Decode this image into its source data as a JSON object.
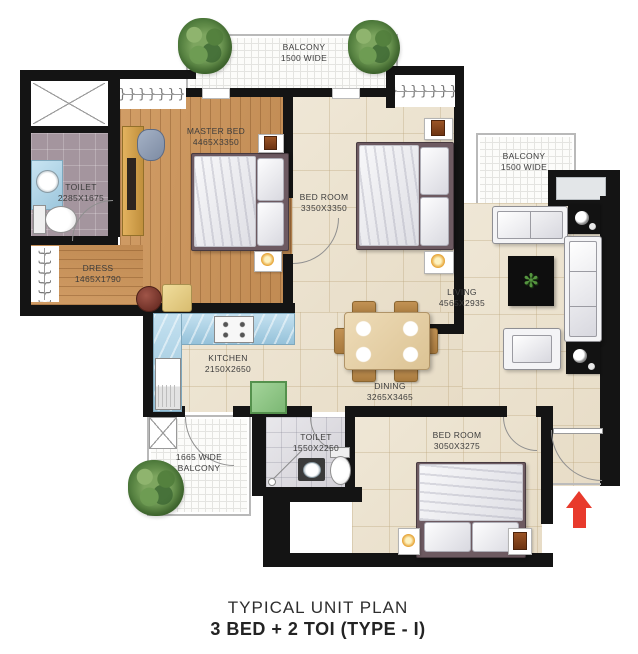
{
  "meta": {
    "title_line1": "TYPICAL UNIT PLAN",
    "title_line2": "3 BED + 2 TOI (TYPE - I)"
  },
  "rooms": {
    "balcony_top": {
      "name": "BALCONY",
      "dim": "1500 WIDE"
    },
    "balcony_right": {
      "name": "BALCONY",
      "dim": "1500 WIDE"
    },
    "balcony_bottom": {
      "line1": "1665 WIDE",
      "line2": "BALCONY"
    },
    "master_bed": {
      "name": "MASTER BED",
      "dim": "4465X3350"
    },
    "bed_room_2": {
      "name": "BED ROOM",
      "dim": "3350X3350"
    },
    "bed_room_3": {
      "name": "BED ROOM",
      "dim": "3050X3275"
    },
    "toilet_1": {
      "name": "TOILET",
      "dim": "2285X1675"
    },
    "toilet_2": {
      "name": "TOILET",
      "dim": "1550X2250"
    },
    "dress": {
      "name": "DRESS",
      "dim": "1465X1790"
    },
    "living": {
      "name": "LIVING",
      "dim": "4565X2935"
    },
    "kitchen": {
      "name": "KITCHEN",
      "dim": "2150X2650"
    },
    "dining": {
      "name": "DINING",
      "dim": "3265X3465"
    }
  },
  "colors": {
    "wall": "#141414",
    "tile_floor": "#ece3d0",
    "wood_floor": "#c9955f",
    "toilet1_floor": "#a4959e",
    "kitchen_counter": "#aed3e6",
    "utility_green": "#90c789",
    "entry_arrow": "#e83a2c",
    "label_text": "#3d3d3d"
  }
}
